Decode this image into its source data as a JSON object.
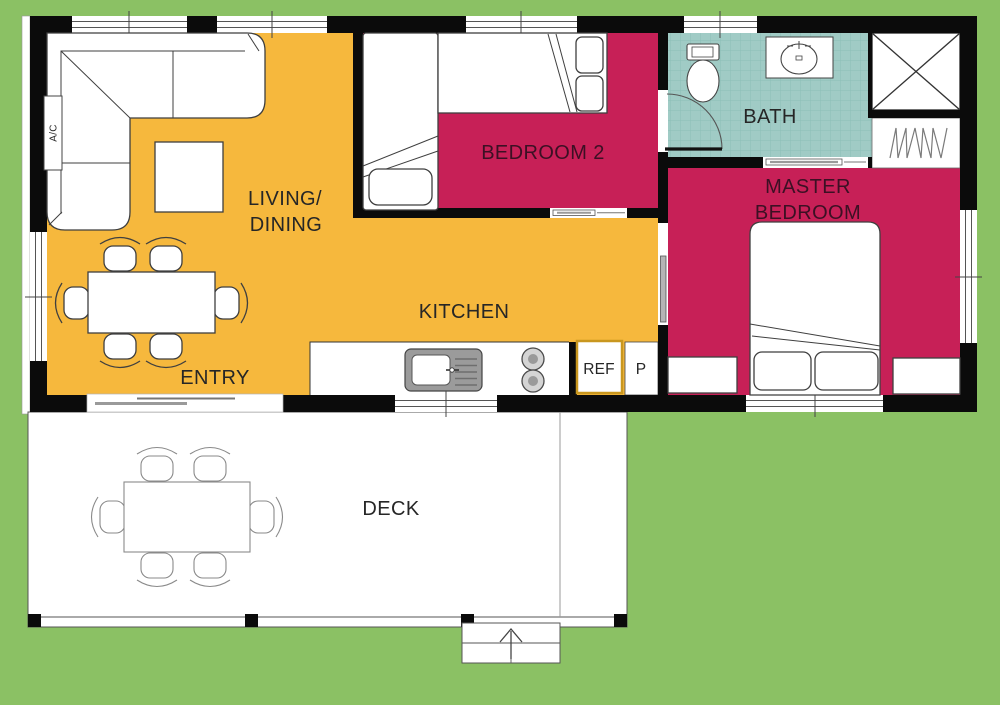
{
  "plan": {
    "type": "house-floor-plan",
    "colors": {
      "background": "#8BC164",
      "living_floor": "#F6B83D",
      "bedroom_floor": "#C72057",
      "bath_floor": "#A0CBC5",
      "bath_grid": "#8CBFB8",
      "wall": "#0B0B0B",
      "deck_floor": "#FFFFFF",
      "ref_border": "#C9971F",
      "label_dark": "#262626",
      "label_maroon": "#3C1024"
    },
    "rooms": {
      "living_dining": {
        "label_line1": "LIVING/",
        "label_line2": "DINING"
      },
      "kitchen": {
        "label": "KITCHEN"
      },
      "entry": {
        "label": "ENTRY"
      },
      "bedroom2": {
        "label": "BEDROOM 2"
      },
      "bath": {
        "label": "BATH"
      },
      "master_bedroom": {
        "label_line1": "MASTER",
        "label_line2": "BEDROOM"
      },
      "deck": {
        "label": "DECK"
      }
    },
    "appliances": {
      "ac_unit": "A/C",
      "refrigerator": "REF",
      "pantry": "P"
    }
  }
}
